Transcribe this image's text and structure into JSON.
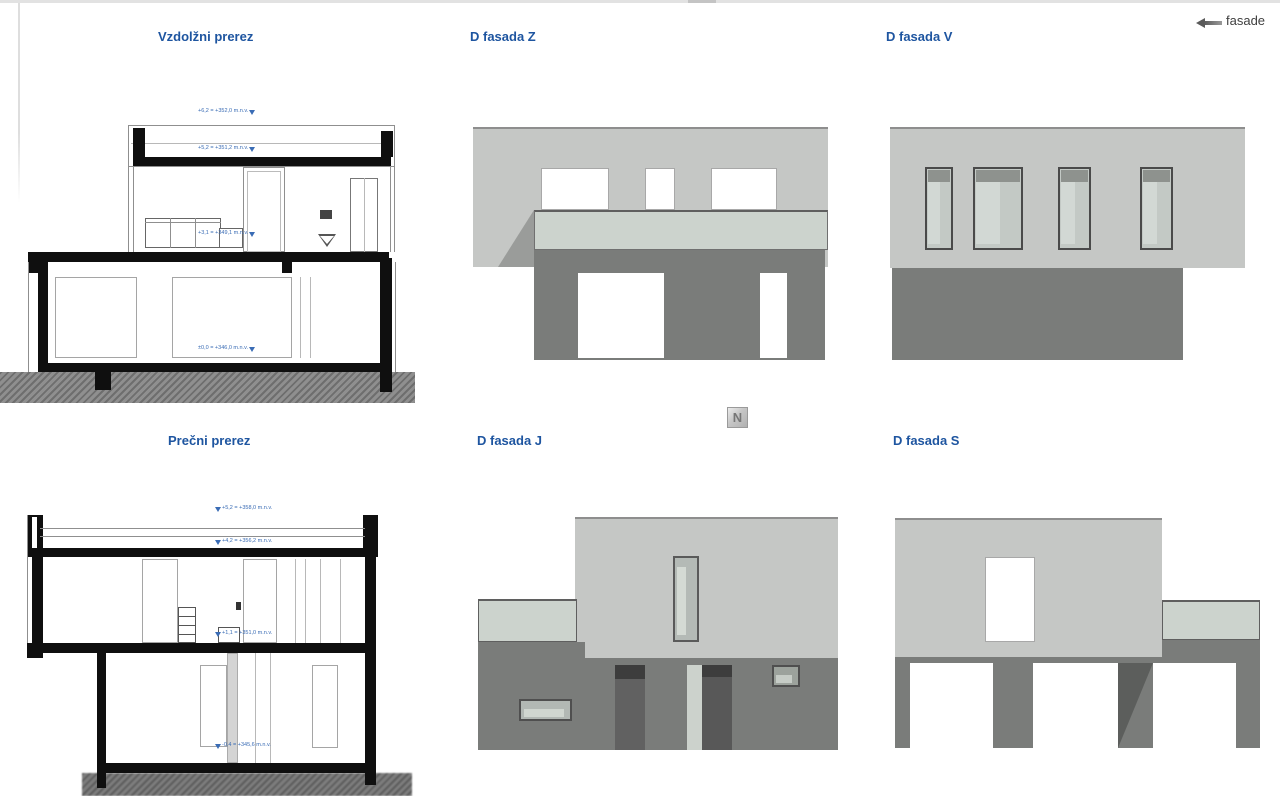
{
  "header": {
    "corner_label": "fasade"
  },
  "north_indicator": {
    "label": "N"
  },
  "panels": {
    "vzdolzni": {
      "title": "Vzdolžni prerez",
      "annotations": [
        "+6,2 = +352,0 m.n.v.",
        "+5,2 = +351,2 m.n.v.",
        "+3,1 = +349,1 m.n.v.",
        "±0,0 = +346,0 m.n.v."
      ]
    },
    "fasada_z": {
      "title": "D fasada Z"
    },
    "fasada_v": {
      "title": "D fasada V"
    },
    "precni": {
      "title": "Prečni prerez",
      "annotations": [
        "+5,2 = +358,0 m.n.v.",
        "+4,2 = +356,2 m.n.v.",
        "+1,1 = +351,0 m.n.v.",
        "-0,4 = +345,6 m.n.v."
      ]
    },
    "fasada_j": {
      "title": "D fasada J"
    },
    "fasada_s": {
      "title": "D fasada S"
    }
  },
  "colors": {
    "title_blue": "#1e55a0",
    "annotation_blue": "#3a6cb5",
    "facade_light": "#c5c7c5",
    "facade_dark": "#7a7c7a",
    "glass_band": "#ccd3cd",
    "section_black": "#0f0f0f"
  }
}
